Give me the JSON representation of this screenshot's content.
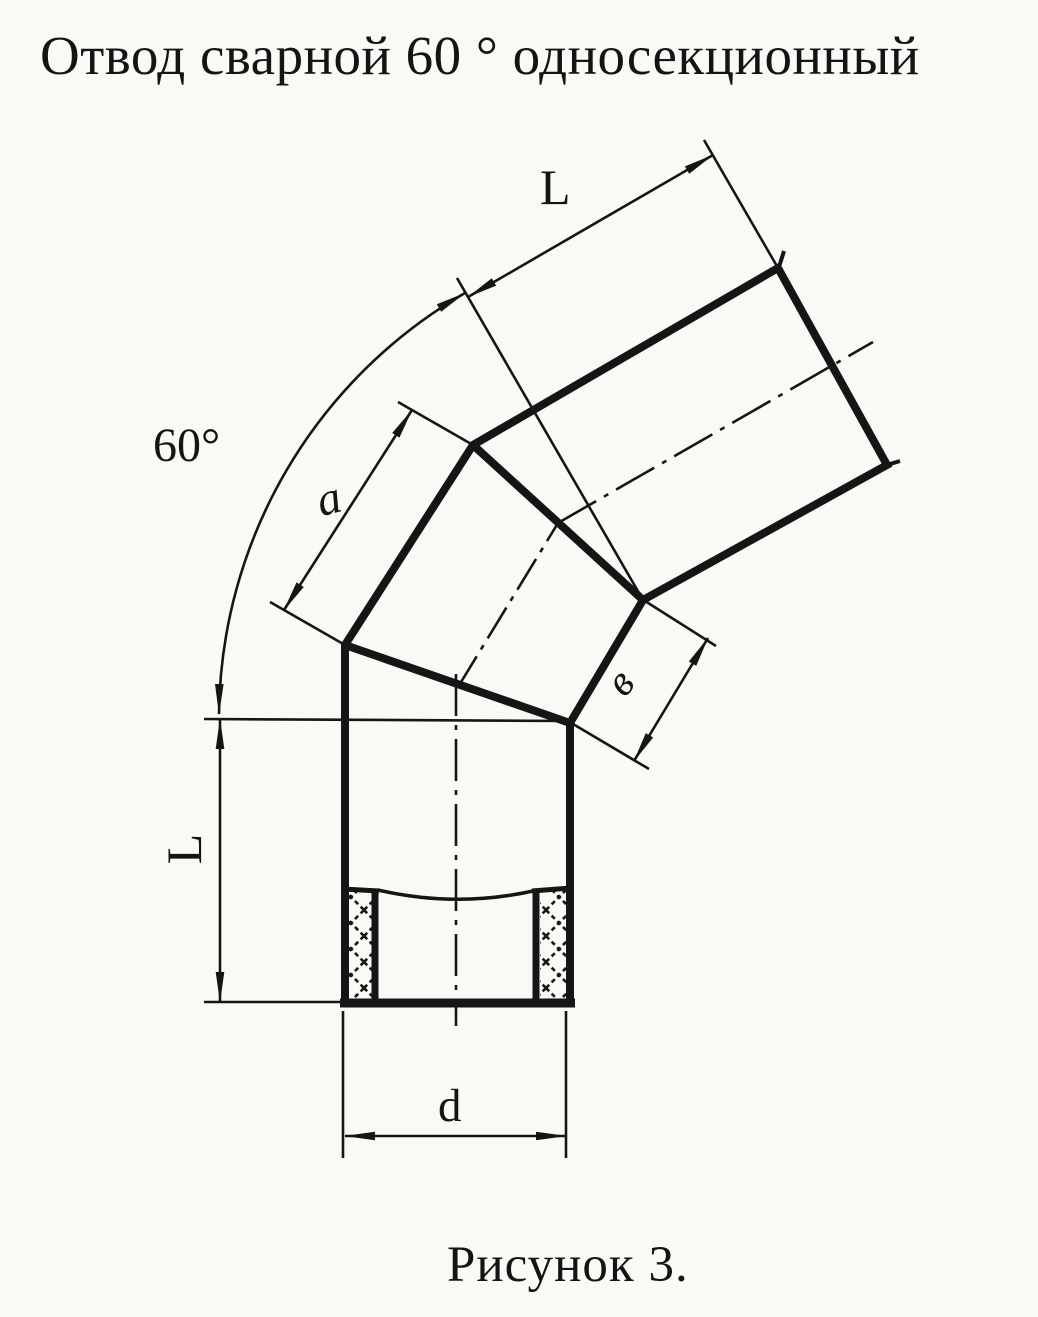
{
  "figure": {
    "title": "Отвод сварной 60 ° односекционный",
    "caption": "Рисунок 3."
  },
  "dimension_labels": {
    "top_section_length": "L",
    "bend_angle": "60°",
    "middle_section_side_a": "a",
    "middle_section_side_v": "в",
    "bottom_section_length": "L",
    "diameter": "d"
  },
  "drawing": {
    "subject": "welded 60-degree single-section pipe elbow",
    "bend_angle_value": "60°",
    "sections": 3,
    "hatch_style": "cross-hatched pipe wall at bottom socket"
  },
  "colors": {
    "ink": "#151515",
    "paper": "#f9f9f6"
  }
}
